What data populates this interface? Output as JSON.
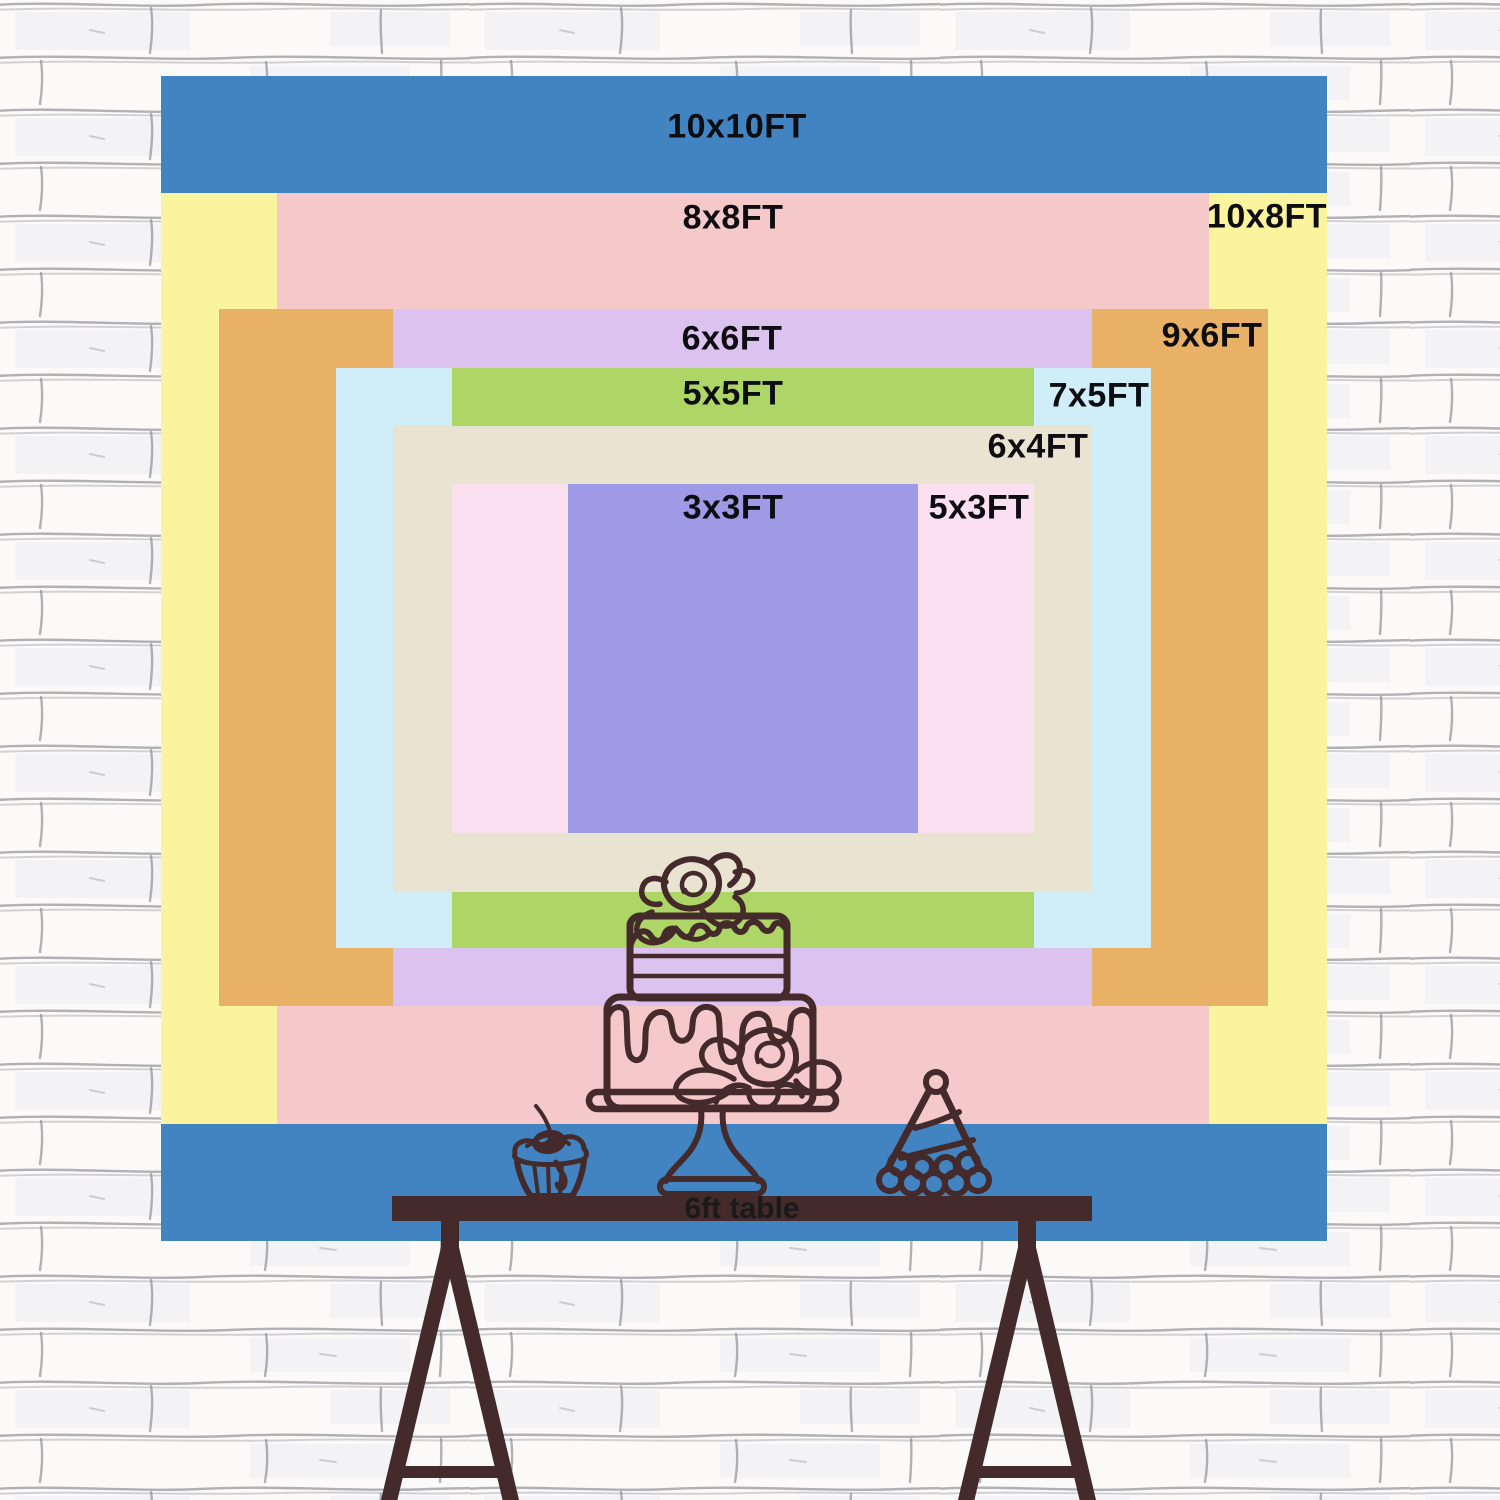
{
  "wall": {
    "background": "#fbfaf9",
    "mortar_color": "#82828b"
  },
  "backdrop": {
    "label_color": "#0d0d12",
    "line_art_color": "#452a2b",
    "sizes": [
      {
        "name": "10x10",
        "label": "10x10FT",
        "width_ft": 10,
        "height_ft": 10,
        "color": "#4284c1",
        "rect": [
          161,
          76,
          1166,
          1165
        ],
        "label_center": [
          737,
          127
        ]
      },
      {
        "name": "10x8",
        "label": "10x8FT",
        "width_ft": 10,
        "height_ft": 8,
        "color": "#fbf49f",
        "rect": [
          161,
          193,
          1166,
          931
        ],
        "label_center": [
          1267,
          217
        ]
      },
      {
        "name": "8x8",
        "label": "8x8FT",
        "width_ft": 8,
        "height_ft": 8,
        "color": "#f5c8c9",
        "rect": [
          277,
          193,
          932,
          931
        ],
        "label_center": [
          733,
          218
        ]
      },
      {
        "name": "9x6",
        "label": "9x6FT",
        "width_ft": 9,
        "height_ft": 6,
        "color": "#e9b165",
        "rect": [
          219,
          309,
          1049,
          697
        ],
        "label_center": [
          1212,
          336
        ]
      },
      {
        "name": "6x6",
        "label": "6x6FT",
        "width_ft": 6,
        "height_ft": 6,
        "color": "#dcc2ee",
        "rect": [
          393,
          309,
          699,
          697
        ],
        "label_center": [
          732,
          339
        ]
      },
      {
        "name": "7x5",
        "label": "7x5FT",
        "width_ft": 7,
        "height_ft": 5,
        "color": "#cfeef8",
        "rect": [
          336,
          368,
          815,
          580
        ],
        "label_center": [
          1099,
          396
        ]
      },
      {
        "name": "5x5",
        "label": "5x5FT",
        "width_ft": 5,
        "height_ft": 5,
        "color": "#aed666",
        "rect": [
          452,
          368,
          582,
          580
        ],
        "label_center": [
          733,
          394
        ]
      },
      {
        "name": "6x4",
        "label": "6x4FT",
        "width_ft": 6,
        "height_ft": 4,
        "color": "#e9e3d2",
        "rect": [
          393,
          426,
          699,
          466
        ],
        "label_center": [
          1038,
          447
        ]
      },
      {
        "name": "5x3",
        "label": "5x3FT",
        "width_ft": 5,
        "height_ft": 3,
        "color": "#fbe0f0",
        "rect": [
          452,
          484,
          582,
          349
        ],
        "label_center": [
          979,
          508
        ]
      },
      {
        "name": "3x3",
        "label": "3x3FT",
        "width_ft": 3,
        "height_ft": 3,
        "color": "#9e9ae6",
        "rect": [
          568,
          484,
          350,
          349
        ],
        "label_center": [
          733,
          508
        ]
      }
    ]
  },
  "table": {
    "label": "6ft table",
    "color": "#452a2b",
    "text_color": "#1a1a1a",
    "bar_rect": [
      392,
      1196,
      700,
      25
    ]
  },
  "decorations": {
    "items": [
      "tiered-cake",
      "cupcake",
      "party-hat"
    ]
  }
}
